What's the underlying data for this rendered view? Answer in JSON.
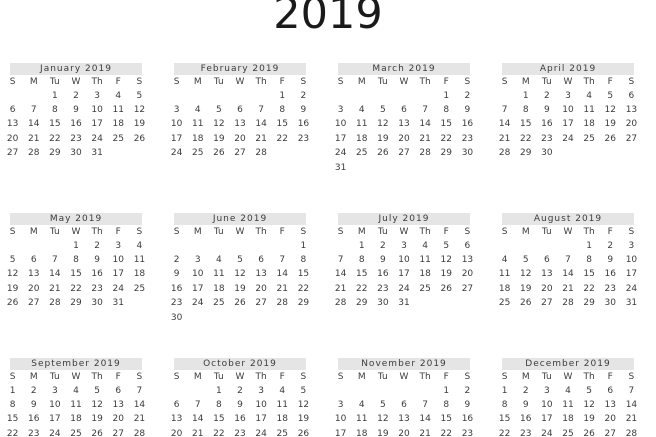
{
  "page": {
    "title": "2019",
    "background": "#ffffff"
  },
  "calendar": {
    "year": "2019",
    "day_headers": [
      "S",
      "M",
      "Tu",
      "W",
      "Th",
      "F",
      "S"
    ],
    "colors": {
      "month_header_bg": "#e5e5e5",
      "text": "#3c3c3c",
      "year_title": "#1a1a1a"
    },
    "months": [
      {
        "title": "January 2019",
        "weeks": [
          [
            "",
            "",
            "1",
            "2",
            "3",
            "4",
            "5"
          ],
          [
            "6",
            "7",
            "8",
            "9",
            "10",
            "11",
            "12"
          ],
          [
            "13",
            "14",
            "15",
            "16",
            "17",
            "18",
            "19"
          ],
          [
            "20",
            "21",
            "22",
            "23",
            "24",
            "25",
            "26"
          ],
          [
            "27",
            "28",
            "29",
            "30",
            "31",
            "",
            ""
          ]
        ]
      },
      {
        "title": "February 2019",
        "weeks": [
          [
            "",
            "",
            "",
            "",
            "",
            "1",
            "2"
          ],
          [
            "3",
            "4",
            "5",
            "6",
            "7",
            "8",
            "9"
          ],
          [
            "10",
            "11",
            "12",
            "13",
            "14",
            "15",
            "16"
          ],
          [
            "17",
            "18",
            "19",
            "20",
            "21",
            "22",
            "23"
          ],
          [
            "24",
            "25",
            "26",
            "27",
            "28",
            "",
            ""
          ]
        ]
      },
      {
        "title": "March 2019",
        "weeks": [
          [
            "",
            "",
            "",
            "",
            "",
            "1",
            "2"
          ],
          [
            "3",
            "4",
            "5",
            "6",
            "7",
            "8",
            "9"
          ],
          [
            "10",
            "11",
            "12",
            "13",
            "14",
            "15",
            "16"
          ],
          [
            "17",
            "18",
            "19",
            "20",
            "21",
            "22",
            "23"
          ],
          [
            "24",
            "25",
            "26",
            "27",
            "28",
            "29",
            "30"
          ],
          [
            "31",
            "",
            "",
            "",
            "",
            "",
            ""
          ]
        ]
      },
      {
        "title": "April 2019",
        "weeks": [
          [
            "",
            "1",
            "2",
            "3",
            "4",
            "5",
            "6"
          ],
          [
            "7",
            "8",
            "9",
            "10",
            "11",
            "12",
            "13"
          ],
          [
            "14",
            "15",
            "16",
            "17",
            "18",
            "19",
            "20"
          ],
          [
            "21",
            "22",
            "23",
            "24",
            "25",
            "26",
            "27"
          ],
          [
            "28",
            "29",
            "30",
            "",
            "",
            "",
            ""
          ]
        ]
      },
      {
        "title": "May 2019",
        "weeks": [
          [
            "",
            "",
            "",
            "1",
            "2",
            "3",
            "4"
          ],
          [
            "5",
            "6",
            "7",
            "8",
            "9",
            "10",
            "11"
          ],
          [
            "12",
            "13",
            "14",
            "15",
            "16",
            "17",
            "18"
          ],
          [
            "19",
            "20",
            "21",
            "22",
            "23",
            "24",
            "25"
          ],
          [
            "26",
            "27",
            "28",
            "29",
            "30",
            "31",
            ""
          ]
        ]
      },
      {
        "title": "June 2019",
        "weeks": [
          [
            "",
            "",
            "",
            "",
            "",
            "",
            "1"
          ],
          [
            "2",
            "3",
            "4",
            "5",
            "6",
            "7",
            "8"
          ],
          [
            "9",
            "10",
            "11",
            "12",
            "13",
            "14",
            "15"
          ],
          [
            "16",
            "17",
            "18",
            "19",
            "20",
            "21",
            "22"
          ],
          [
            "23",
            "24",
            "25",
            "26",
            "27",
            "28",
            "29"
          ],
          [
            "30",
            "",
            "",
            "",
            "",
            "",
            ""
          ]
        ]
      },
      {
        "title": "July 2019",
        "weeks": [
          [
            "",
            "1",
            "2",
            "3",
            "4",
            "5",
            "6"
          ],
          [
            "7",
            "8",
            "9",
            "10",
            "11",
            "12",
            "13"
          ],
          [
            "14",
            "15",
            "16",
            "17",
            "18",
            "19",
            "20"
          ],
          [
            "21",
            "22",
            "23",
            "24",
            "25",
            "26",
            "27"
          ],
          [
            "28",
            "29",
            "30",
            "31",
            "",
            "",
            ""
          ]
        ]
      },
      {
        "title": "August 2019",
        "weeks": [
          [
            "",
            "",
            "",
            "",
            "1",
            "2",
            "3"
          ],
          [
            "4",
            "5",
            "6",
            "7",
            "8",
            "9",
            "10"
          ],
          [
            "11",
            "12",
            "13",
            "14",
            "15",
            "16",
            "17"
          ],
          [
            "18",
            "19",
            "20",
            "21",
            "22",
            "23",
            "24"
          ],
          [
            "25",
            "26",
            "27",
            "28",
            "29",
            "30",
            "31"
          ]
        ]
      },
      {
        "title": "September 2019",
        "weeks": [
          [
            "1",
            "2",
            "3",
            "4",
            "5",
            "6",
            "7"
          ],
          [
            "8",
            "9",
            "10",
            "11",
            "12",
            "13",
            "14"
          ],
          [
            "15",
            "16",
            "17",
            "18",
            "19",
            "20",
            "21"
          ],
          [
            "22",
            "23",
            "24",
            "25",
            "26",
            "27",
            "28"
          ]
        ]
      },
      {
        "title": "October 2019",
        "weeks": [
          [
            "",
            "",
            "1",
            "2",
            "3",
            "4",
            "5"
          ],
          [
            "6",
            "7",
            "8",
            "9",
            "10",
            "11",
            "12"
          ],
          [
            "13",
            "14",
            "15",
            "16",
            "17",
            "18",
            "19"
          ],
          [
            "20",
            "21",
            "22",
            "23",
            "24",
            "25",
            "26"
          ]
        ]
      },
      {
        "title": "November 2019",
        "weeks": [
          [
            "",
            "",
            "",
            "",
            "",
            "1",
            "2"
          ],
          [
            "3",
            "4",
            "5",
            "6",
            "7",
            "8",
            "9"
          ],
          [
            "10",
            "11",
            "12",
            "13",
            "14",
            "15",
            "16"
          ],
          [
            "17",
            "18",
            "19",
            "20",
            "21",
            "22",
            "23"
          ]
        ]
      },
      {
        "title": "December 2019",
        "weeks": [
          [
            "1",
            "2",
            "3",
            "4",
            "5",
            "6",
            "7"
          ],
          [
            "8",
            "9",
            "10",
            "11",
            "12",
            "13",
            "14"
          ],
          [
            "15",
            "16",
            "17",
            "18",
            "19",
            "20",
            "21"
          ],
          [
            "22",
            "23",
            "24",
            "25",
            "26",
            "27",
            "28"
          ]
        ]
      }
    ],
    "layout": {
      "columns": 4,
      "rows": 3,
      "column_width": 164,
      "row_tops": [
        63,
        213,
        358
      ],
      "month_left_offset": 2
    }
  }
}
